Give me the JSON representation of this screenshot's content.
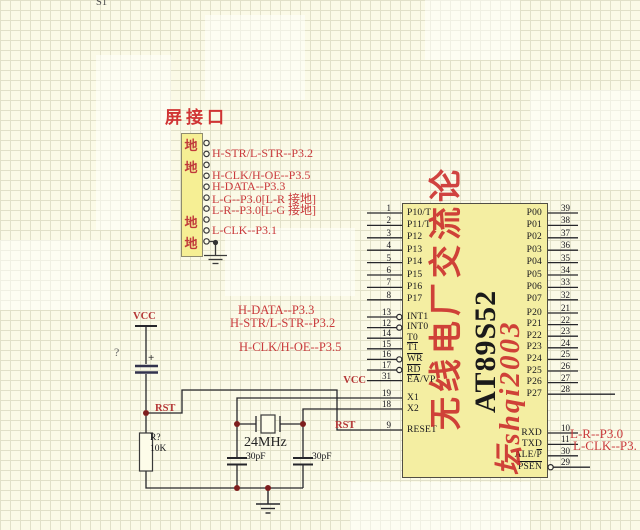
{
  "page": {
    "s1": "S1"
  },
  "connector": {
    "title": "屏接口",
    "pins": [
      {
        "label": "地",
        "kind": "gnd"
      },
      {
        "label": "H-STR/L-STR--P3.2",
        "kind": "signal"
      },
      {
        "label": "地",
        "kind": "gnd"
      },
      {
        "label": "H-CLK/H-OE--P3.5",
        "kind": "signal"
      },
      {
        "label": "H-DATA--P3.3",
        "kind": "signal"
      },
      {
        "label": "L-G--P3.0[L-R 接地]",
        "kind": "signal"
      },
      {
        "label": "L-R--P3.0[L-G 接地]",
        "kind": "signal"
      },
      {
        "label": "地",
        "kind": "gnd"
      },
      {
        "label": "L-CLK--P3.1",
        "kind": "signal"
      },
      {
        "label": "地",
        "kind": "gnd"
      }
    ]
  },
  "mid_labels": [
    "H-DATA--P3.3",
    "H-STR/L-STR--P3.2",
    "H-CLK/H-OE--P3.5"
  ],
  "right_labels": [
    "L-R--P3.0",
    "L-CLK--P3."
  ],
  "power": {
    "vcc": "VCC",
    "rst": "RST",
    "vcc_pin": "VCC",
    "rst_pin": "RST"
  },
  "components": {
    "cap_plus": "+",
    "unknown_ref": "?",
    "resistor_ref": "R?",
    "resistor_value": "10K",
    "crystal_value": "24MHz",
    "cap1_value": "30pF",
    "cap2_value": "30pF"
  },
  "ic": {
    "part": "AT89S52",
    "watermark_col1": "无线电厂交流论",
    "watermark_col2": "坛shqi2003",
    "pins": {
      "left1": [
        {
          "n": "1",
          "label": "P10/T"
        },
        {
          "n": "2",
          "label": "P11/T"
        },
        {
          "n": "3",
          "label": "P12"
        },
        {
          "n": "4",
          "label": "P13"
        },
        {
          "n": "5",
          "label": "P14"
        },
        {
          "n": "6",
          "label": "P15"
        },
        {
          "n": "7",
          "label": "P16"
        },
        {
          "n": "8",
          "label": "P17"
        }
      ],
      "left2": [
        {
          "n": "13",
          "label": "INT1",
          "bubble": true
        },
        {
          "n": "12",
          "label": "INT0",
          "bubble": true
        },
        {
          "n": "14",
          "label": "T0"
        },
        {
          "n": "15",
          "parts": [
            "",
            "T1",
            ""
          ]
        },
        {
          "n": "16",
          "parts": [
            "",
            "WR",
            ""
          ],
          "bubble": true
        },
        {
          "n": "17",
          "parts": [
            "",
            "RD",
            ""
          ],
          "bubble": true
        },
        {
          "n": "31",
          "parts": [
            "",
            "EA",
            "/VP"
          ]
        }
      ],
      "left3": [
        {
          "n": "19",
          "label": "X1"
        },
        {
          "n": "18",
          "label": "X2"
        }
      ],
      "left4": [
        {
          "n": "9",
          "label": "RESET"
        }
      ],
      "right1": [
        {
          "n": "39",
          "label": "P00"
        },
        {
          "n": "38",
          "label": "P01"
        },
        {
          "n": "37",
          "label": "P02"
        },
        {
          "n": "36",
          "label": "P03"
        },
        {
          "n": "35",
          "label": "P04"
        },
        {
          "n": "34",
          "label": "P05"
        },
        {
          "n": "33",
          "label": "P06"
        },
        {
          "n": "32",
          "label": "P07"
        }
      ],
      "right2": [
        {
          "n": "21",
          "label": "P20"
        },
        {
          "n": "22",
          "label": "P21"
        },
        {
          "n": "23",
          "label": "P22"
        },
        {
          "n": "24",
          "label": "P23"
        },
        {
          "n": "25",
          "label": "P24"
        },
        {
          "n": "26",
          "label": "P25"
        },
        {
          "n": "27",
          "label": "P26"
        },
        {
          "n": "28",
          "label": "P27",
          "long": true
        }
      ],
      "right3": [
        {
          "n": "10",
          "label": "RXD"
        },
        {
          "n": "11",
          "label": "TXD"
        },
        {
          "n": "30",
          "parts": [
            "ALE/",
            "P",
            ""
          ]
        },
        {
          "n": "29",
          "parts": [
            "",
            "PSEN",
            ""
          ],
          "bubble": true
        }
      ]
    }
  },
  "colors": {
    "accent_red": "#c93a3c",
    "watermark_red": "#cb2a2a",
    "ic_fill": "#f4eea2",
    "wire": "#26262b",
    "junction_dot": "#7e1e1e",
    "background": "#fbfae7"
  }
}
